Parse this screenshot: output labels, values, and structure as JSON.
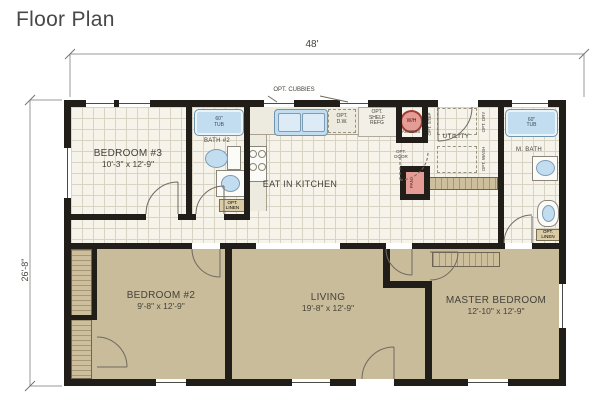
{
  "title": "Floor Plan",
  "dimensions": {
    "width": "48'",
    "depth": "26'-8\""
  },
  "rooms": {
    "bedroom3": {
      "name": "BEDROOM #3",
      "size": "10'-3\" x 12'-9\""
    },
    "bath2": {
      "name": "BATH #2"
    },
    "kitchen": {
      "name": "EAT IN KITCHEN"
    },
    "utility": {
      "name": "UTILITY"
    },
    "mbath": {
      "name": "M. BATH"
    },
    "bedroom2": {
      "name": "BEDROOM #2",
      "size": "9'-8\" x 12'-9\""
    },
    "living": {
      "name": "LIVING",
      "size": "19'-8\" x 12'-9\""
    },
    "master": {
      "name": "MASTER BEDROOM",
      "size": "12'-10\" x 12'-9\""
    }
  },
  "labels": {
    "cubbies": "OPT. CUBBIES",
    "bar": "BAR",
    "dw": [
      "OPT.",
      "D.W."
    ],
    "refg": [
      "OPT.",
      "SHELF",
      "REFG"
    ],
    "wh": "W/H",
    "access": "ACCESS",
    "opt_step": "OPT. STEP",
    "opt_door": [
      "OPT.",
      "DOOR"
    ],
    "pantry": "PAN.",
    "opt_dry": "OPT. DRY",
    "opt_wash": "OPT. WASH",
    "tub": [
      "60\"",
      "TUB"
    ],
    "linen": [
      "OPT.",
      "LINEN"
    ]
  },
  "colors": {
    "wall": "#211e19",
    "carpet": "#c9bc9b",
    "grid_floor": "#f6f3ea",
    "fixture_blue": "#c3ddf0",
    "accent_red": "#e59c95",
    "linen_tan": "#dacca5"
  }
}
